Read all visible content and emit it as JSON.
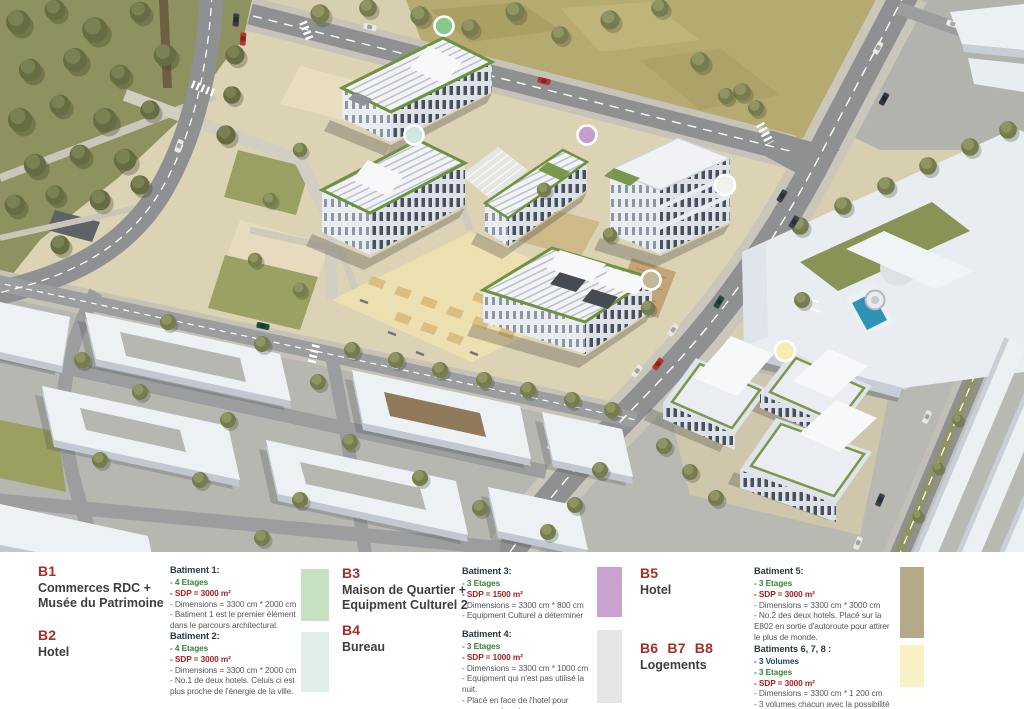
{
  "map": {
    "description": "Aerial 3D masterplan rendering with six building location markers"
  },
  "legend": {
    "entries": [
      {
        "id": "B1",
        "title1": "Commerces  RDC +",
        "title2": "Musée du Patrimoine",
        "heading": "Batiment 1:",
        "etages": "- 4 Etages",
        "sdp": "- SDP = 3000 m²",
        "dims": "- Dimensions =  3300 cm * 2000 cm",
        "note1": "- Batiment 1 est le premier élément dans le parcours architectural.",
        "swatch": "#c8e1c3",
        "dot": "#86c88e"
      },
      {
        "id": "B2",
        "title1": "Hotel",
        "title2": "",
        "heading": "Batiment 2:",
        "etages": "- 4 Etages",
        "sdp": "- SDP = 3000 m²",
        "dims": "- Dimensions = 3300 cm * 2000 cm",
        "note1": "- No.1 de deux hotels. Celuis ci est plus proche de l'énergie de la ville.",
        "swatch": "#dfeee9",
        "dot": "#cfe7e0"
      },
      {
        "id": "B3",
        "title1": "Maison de Quartier +",
        "title2": "Equipment Culturel 2",
        "heading": "Batiment 3:",
        "etages": "- 3 Etages",
        "sdp": "- SDP = 1500 m²",
        "dims": "- Dimensions = 3300 cm * 800 cm",
        "note1": "- Equipment Culturel a déterminer",
        "swatch": "#c9a3cf",
        "dot": "#c39fcd"
      },
      {
        "id": "B4",
        "title1": "Bureau",
        "title2": "",
        "heading": "Batiment 4:",
        "etages": "- 3 Etages",
        "sdp": "- SDP = 1000 m²",
        "dims": "- Dimensions = 3300 cm * 1000 cm",
        "note1": "- Equipment qui n'est pas utilisé la nuit.",
        "note2": "- Placé en face de l'hotel pour ammener du calme.",
        "swatch": "#e6e6e4",
        "dot": "#f1f1ea"
      },
      {
        "id": "B5",
        "title1": "Hotel",
        "title2": "",
        "heading": "Batiment 5:",
        "etages": "- 3 Etages",
        "sdp": "- SDP = 3000 m²",
        "dims": "- Dimensions = 3300 cm * 3000 cm",
        "note1": "- No.2 des deux hotels. Placé sur la E802 en sortie d'autoroute pour attirer le plus de monde.",
        "swatch": "#b4aa8a",
        "dot": "#c5b795"
      },
      {
        "id": "B6 B7 B8",
        "title1": "Logements",
        "title2": "",
        "heading": "Batiments 6, 7, 8 :",
        "volumes": "- 3 Volumes",
        "etages": "- 3 Etages",
        "sdp": "- SDP = 3000 m²",
        "dims": "- Dimensions = 3300 cm * 1 200 cm",
        "note1": "- 3 volumes chacun avec la possibilité d'évolution",
        "swatch": "#f8f1c4",
        "dot": "#f5eeb0"
      }
    ]
  }
}
